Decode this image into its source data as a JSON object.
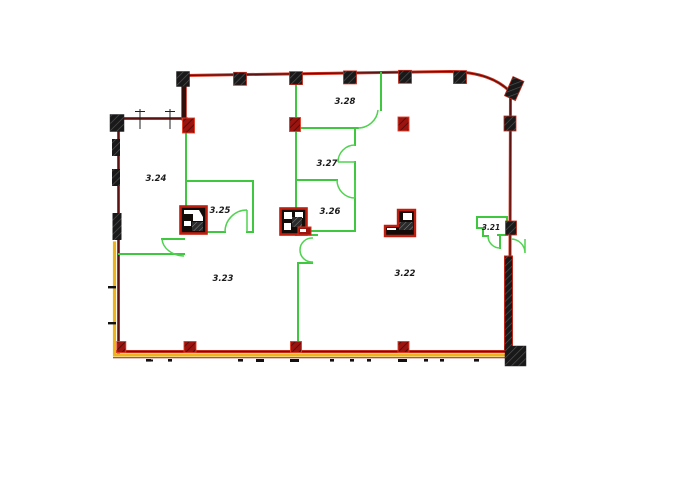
{
  "drawing": {
    "type": "architectural-floor-plan",
    "background": "#ffffff"
  },
  "colors": {
    "exterior_wall_red": "#d2301c",
    "exterior_wall_core": "#5c1210",
    "partition_green": "#3fc83f",
    "accent_band_yellow": "#ecb31c",
    "column_black": "#191919",
    "column_red": "#9c1410",
    "label_color": "#1c1c1c"
  },
  "rooms": [
    {
      "label": "3.28"
    },
    {
      "label": "3.27"
    },
    {
      "label": "3.26"
    },
    {
      "label": "3.25"
    },
    {
      "label": "3.24"
    },
    {
      "label": "3.23"
    },
    {
      "label": "3.22"
    },
    {
      "label": "3.21"
    }
  ]
}
